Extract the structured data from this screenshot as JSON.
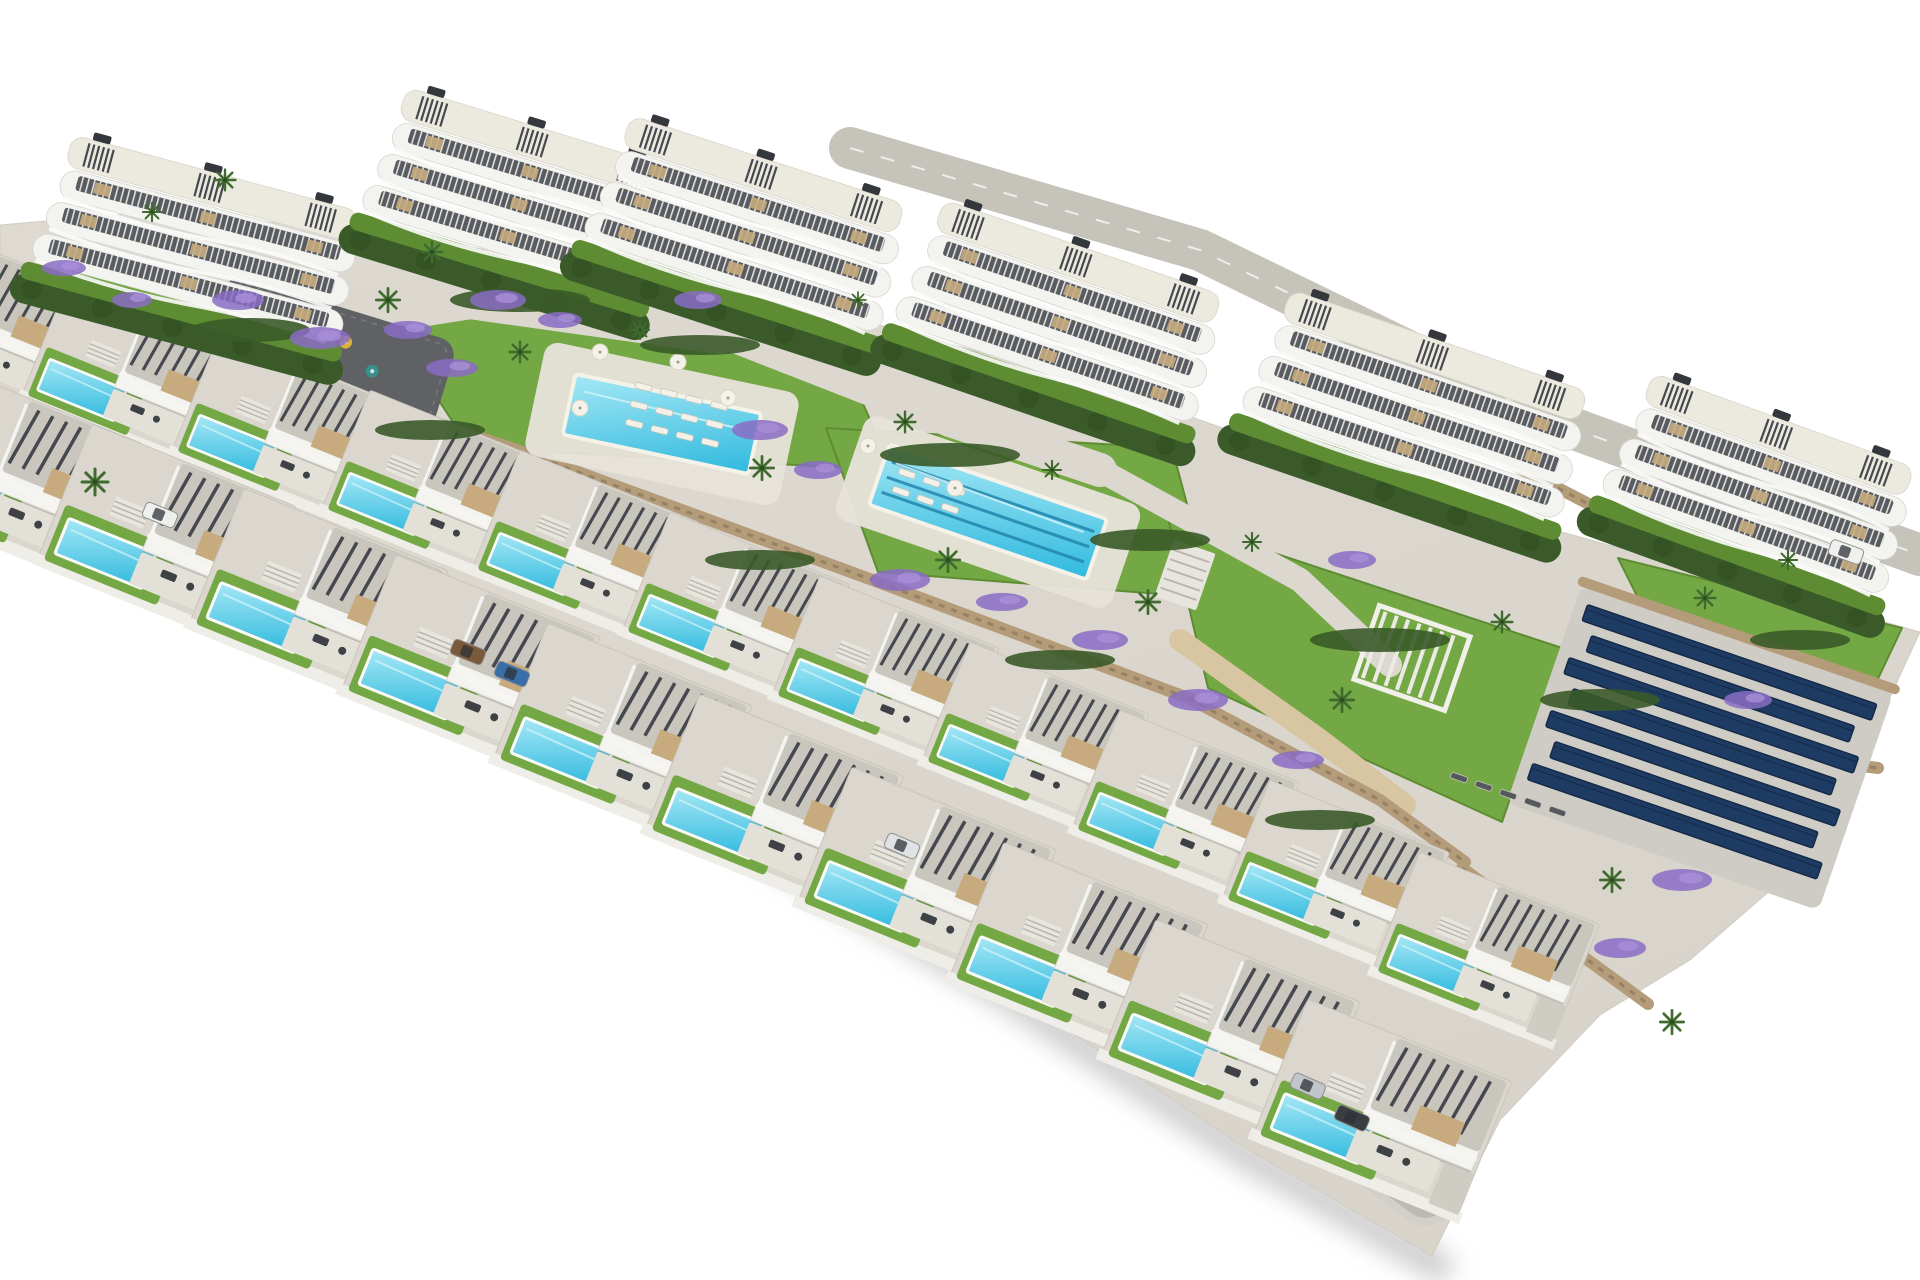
{
  "scene": {
    "description": "Aerial 3D architectural render of a hillside residential development: six white apartment blocks with wavy balconies along the top, two stepped rows of modern villas with private turquoise pools in the foreground, communal lawns with a main pool and a lap pool, a playground, pergola, stone retaining walls, palm trees, purple flower beds and a solar panel array on the right. White background.",
    "background": "#ffffff"
  },
  "palette": {
    "site": "#d8d4cc",
    "site_light": "#dedad2",
    "edge_shadow": "#9c9c9c",
    "road": "#bdbab3",
    "top_road": "#c6c3bb",
    "path": "#dcd8d0",
    "sand": "#d8c6a3",
    "grass": "#74a844",
    "grass_dark": "#5d8c33",
    "hedge": "#3a5a29",
    "hedge_dark": "#335124",
    "stone_wall": "#b49b79",
    "stone_wall_dark": "#8f7a5c",
    "asphalt": "#5f6164",
    "water_light": "#a5e8f5",
    "water_deep": "#2fb9de",
    "lane_line": "#2286ad",
    "coping": "#f5f2ea",
    "building_white": "#f3f3f0",
    "building_shade": "#d6d5d0",
    "window_strip": "#585b60",
    "roof_deck": "#eceade",
    "roof_gravel": "#c9c6be",
    "pergola_slat": "#45494f",
    "tan_accent": "#c7ab7e",
    "terrace": "#e3e0d8",
    "plot": "#dbd7cf",
    "solar_panel": "#1e3c63",
    "solar_panel_dark": "#152a47",
    "solar_pad": "#cfccc5",
    "purple": "#8a6cc4",
    "palm": "#3f6b2f",
    "palm_dark": "#2e4d1f",
    "lounger": "#f4f1e9",
    "lounger_dark": "#55585c",
    "stairs": "#e8e5de",
    "stair_line": "#b9b6ae",
    "furniture": "#3e4246",
    "driveway": "#cfccc4"
  },
  "site_outline": {
    "top": [
      [
        0,
        225
      ],
      [
        150,
        212
      ],
      [
        360,
        230
      ],
      [
        520,
        255
      ],
      [
        720,
        290
      ],
      [
        900,
        330
      ],
      [
        1100,
        385
      ],
      [
        1300,
        455
      ],
      [
        1500,
        515
      ],
      [
        1700,
        570
      ],
      [
        1920,
        632
      ]
    ],
    "right": [
      [
        1920,
        632
      ],
      [
        1868,
        745
      ],
      [
        1788,
        875
      ],
      [
        1690,
        960
      ],
      [
        1600,
        1015
      ],
      [
        1500,
        1120
      ],
      [
        1432,
        1256
      ]
    ],
    "bottom": [
      [
        1432,
        1256
      ],
      [
        1240,
        1145
      ],
      [
        1000,
        985
      ],
      [
        850,
        895
      ],
      [
        700,
        800
      ],
      [
        550,
        710
      ],
      [
        400,
        625
      ],
      [
        260,
        560
      ],
      [
        150,
        535
      ],
      [
        60,
        515
      ],
      [
        0,
        505
      ]
    ]
  },
  "apartment_blocks": [
    {
      "x": 62,
      "y": 138,
      "rot": 15,
      "w": 320
    },
    {
      "x": 396,
      "y": 90,
      "rot": 17,
      "w": 300
    },
    {
      "x": 620,
      "y": 118,
      "rot": 18,
      "w": 312
    },
    {
      "x": 933,
      "y": 202,
      "rot": 19,
      "w": 318
    },
    {
      "x": 1280,
      "y": 292,
      "rot": 19,
      "w": 338
    },
    {
      "x": 1642,
      "y": 375,
      "rot": 20,
      "w": 302
    }
  ],
  "villa_rows": [
    {
      "name": "back-villa-row",
      "count": 11,
      "x0": -80,
      "y0": 222,
      "dx": 150,
      "dy": 54,
      "accel": 2.0,
      "scale": 0.88
    },
    {
      "name": "front-villa-row",
      "count": 10,
      "x0": -60,
      "y0": 362,
      "dx": 152,
      "dy": 62,
      "accel": 2.2,
      "scale": 1.0
    }
  ],
  "roads": {
    "villa_road": [
      [
        -40,
        460
      ],
      [
        300,
        610
      ],
      [
        700,
        800
      ],
      [
        1050,
        960
      ],
      [
        1300,
        1100
      ],
      [
        1425,
        1195
      ]
    ],
    "top_road": [
      [
        850,
        148
      ],
      [
        1200,
        250
      ],
      [
        1550,
        420
      ],
      [
        1920,
        555
      ]
    ]
  },
  "communal_pools": [
    {
      "name": "main-pool",
      "cx": 662,
      "cy": 424,
      "rot": 12,
      "w": 190,
      "h": 62,
      "deck_w": 260,
      "deck_h": 116,
      "lanes": 0
    },
    {
      "name": "lap-pool",
      "cx": 988,
      "cy": 512,
      "rot": 19,
      "w": 230,
      "h": 64,
      "deck_w": 292,
      "deck_h": 110,
      "lanes": 3
    }
  ],
  "solar_array": {
    "cx": 1700,
    "cy": 748,
    "rot": 19,
    "pad_w": 330,
    "pad_h": 230,
    "panels": 7
  },
  "playground": {
    "cx": 330,
    "cy": 352,
    "rot": 17,
    "w": 240,
    "h": 92,
    "equipment": [
      [
        -62,
        -6,
        "#e07b2a"
      ],
      [
        -20,
        12,
        "#c6483a"
      ],
      [
        12,
        -14,
        "#d9b23c"
      ],
      [
        46,
        6,
        "#3a8f8a"
      ]
    ]
  },
  "pergola": {
    "cx": 1412,
    "cy": 658,
    "rot": 19,
    "w": 96,
    "h": 78
  },
  "stairs": [
    {
      "cx": 1185,
      "cy": 575,
      "rot": 19,
      "w": 44,
      "h": 60
    },
    {
      "cx": 96,
      "cy": 305,
      "rot": 16,
      "w": 30,
      "h": 46
    }
  ],
  "lawns": [
    [
      [
        40,
        248
      ],
      [
        372,
        318
      ],
      [
        332,
        392
      ],
      [
        58,
        330
      ]
    ],
    [
      [
        378,
        308
      ],
      [
        830,
        328
      ],
      [
        892,
        470
      ],
      [
        470,
        448
      ]
    ],
    [
      [
        826,
        428
      ],
      [
        1172,
        448
      ],
      [
        1212,
        598
      ],
      [
        878,
        572
      ]
    ],
    [
      [
        1168,
        518
      ],
      [
        1562,
        648
      ],
      [
        1502,
        822
      ],
      [
        1208,
        688
      ]
    ],
    [
      [
        1618,
        558
      ],
      [
        1902,
        628
      ],
      [
        1848,
        742
      ],
      [
        1678,
        678
      ]
    ]
  ],
  "paths": [
    {
      "pts": [
        [
          250,
          330
        ],
        [
          470,
          295
        ],
        [
          720,
          330
        ]
      ],
      "wd": 48,
      "c": "path"
    },
    {
      "pts": [
        [
          720,
          330
        ],
        [
          950,
          420
        ],
        [
          1100,
          470
        ]
      ],
      "wd": 34,
      "c": "path"
    },
    {
      "pts": [
        [
          1100,
          470
        ],
        [
          1300,
          580
        ],
        [
          1390,
          665
        ]
      ],
      "wd": 24,
      "c": "path"
    },
    {
      "pts": [
        [
          1180,
          640
        ],
        [
          1320,
          740
        ],
        [
          1405,
          805
        ]
      ],
      "wd": 22,
      "c": "sand"
    }
  ],
  "stone_walls": [
    [
      [
        228,
        352
      ],
      [
        540,
        458
      ]
    ],
    [
      [
        540,
        458
      ],
      [
        878,
        582
      ]
    ],
    [
      [
        878,
        582
      ],
      [
        1188,
        698
      ]
    ],
    [
      [
        1188,
        698
      ],
      [
        1380,
        800
      ],
      [
        1465,
        862
      ]
    ],
    [
      [
        1570,
        688
      ],
      [
        1748,
        752
      ],
      [
        1878,
        768
      ]
    ],
    [
      [
        1500,
        458
      ],
      [
        1662,
        542
      ]
    ],
    [
      [
        1462,
        868
      ],
      [
        1648,
        1004
      ]
    ]
  ],
  "palms": [
    [
      95,
      482,
      1
    ],
    [
      225,
      180,
      0.8
    ],
    [
      152,
      212,
      0.7
    ],
    [
      388,
      300,
      0.9
    ],
    [
      432,
      252,
      0.8
    ],
    [
      520,
      352,
      0.8
    ],
    [
      640,
      330,
      0.7
    ],
    [
      762,
      468,
      0.9
    ],
    [
      905,
      422,
      0.8
    ],
    [
      948,
      560,
      0.9
    ],
    [
      1052,
      470,
      0.7
    ],
    [
      1148,
      602,
      0.9
    ],
    [
      1252,
      542,
      0.7
    ],
    [
      1342,
      700,
      0.9
    ],
    [
      1502,
      622,
      0.8
    ],
    [
      1612,
      880,
      0.9
    ],
    [
      1705,
      598,
      0.8
    ],
    [
      1788,
      560,
      0.7
    ],
    [
      1672,
      1022,
      0.9
    ],
    [
      858,
      300,
      0.6
    ]
  ],
  "flowers": [
    [
      238,
      300,
      26,
      10
    ],
    [
      320,
      338,
      30,
      11
    ],
    [
      408,
      330,
      24,
      9
    ],
    [
      498,
      300,
      28,
      10
    ],
    [
      560,
      320,
      22,
      8
    ],
    [
      452,
      368,
      26,
      9
    ],
    [
      698,
      300,
      24,
      9
    ],
    [
      760,
      430,
      28,
      10
    ],
    [
      818,
      470,
      24,
      9
    ],
    [
      900,
      580,
      30,
      11
    ],
    [
      1002,
      602,
      26,
      9
    ],
    [
      1100,
      640,
      28,
      10
    ],
    [
      1198,
      700,
      30,
      11
    ],
    [
      1298,
      760,
      26,
      9
    ],
    [
      1352,
      560,
      24,
      9
    ],
    [
      1682,
      880,
      30,
      11
    ],
    [
      1748,
      700,
      24,
      9
    ],
    [
      64,
      268,
      22,
      8
    ],
    [
      132,
      300,
      20,
      8
    ],
    [
      1620,
      948,
      26,
      10
    ]
  ],
  "hedges": [
    [
      250,
      330,
      60,
      12
    ],
    [
      520,
      300,
      70,
      12
    ],
    [
      700,
      345,
      60,
      10
    ],
    [
      950,
      455,
      70,
      12
    ],
    [
      1150,
      540,
      60,
      11
    ],
    [
      1380,
      640,
      70,
      12
    ],
    [
      1600,
      700,
      60,
      11
    ],
    [
      1800,
      640,
      50,
      10
    ],
    [
      430,
      430,
      55,
      10
    ],
    [
      760,
      560,
      55,
      10
    ],
    [
      1060,
      660,
      55,
      10
    ],
    [
      1320,
      820,
      55,
      10
    ]
  ],
  "cars": [
    [
      160,
      515,
      22,
      "#eef0ee"
    ],
    [
      468,
      652,
      22,
      "#7a5a3a"
    ],
    [
      512,
      674,
      22,
      "#3a6ea8"
    ],
    [
      902,
      846,
      23,
      "#e0e3e5"
    ],
    [
      1308,
      1086,
      24,
      "#c2c5ca"
    ],
    [
      1352,
      1118,
      24,
      "#3a3d42"
    ],
    [
      1846,
      552,
      20,
      "#f0f0ee"
    ]
  ],
  "lounger_groups": [
    {
      "cx": 636,
      "cy": 382,
      "rot": 14,
      "rows": 3,
      "cols": 4,
      "c": "light"
    },
    {
      "cx": 900,
      "cy": 468,
      "rot": 19,
      "rows": 2,
      "cols": 3,
      "c": "light"
    },
    {
      "cx": 1452,
      "cy": 772,
      "rot": 19,
      "rows": 1,
      "cols": 5,
      "c": "dark"
    }
  ],
  "parasols": [
    [
      600,
      352
    ],
    [
      678,
      362
    ],
    [
      728,
      398
    ],
    [
      580,
      408
    ],
    [
      868,
      446
    ],
    [
      955,
      488
    ]
  ]
}
